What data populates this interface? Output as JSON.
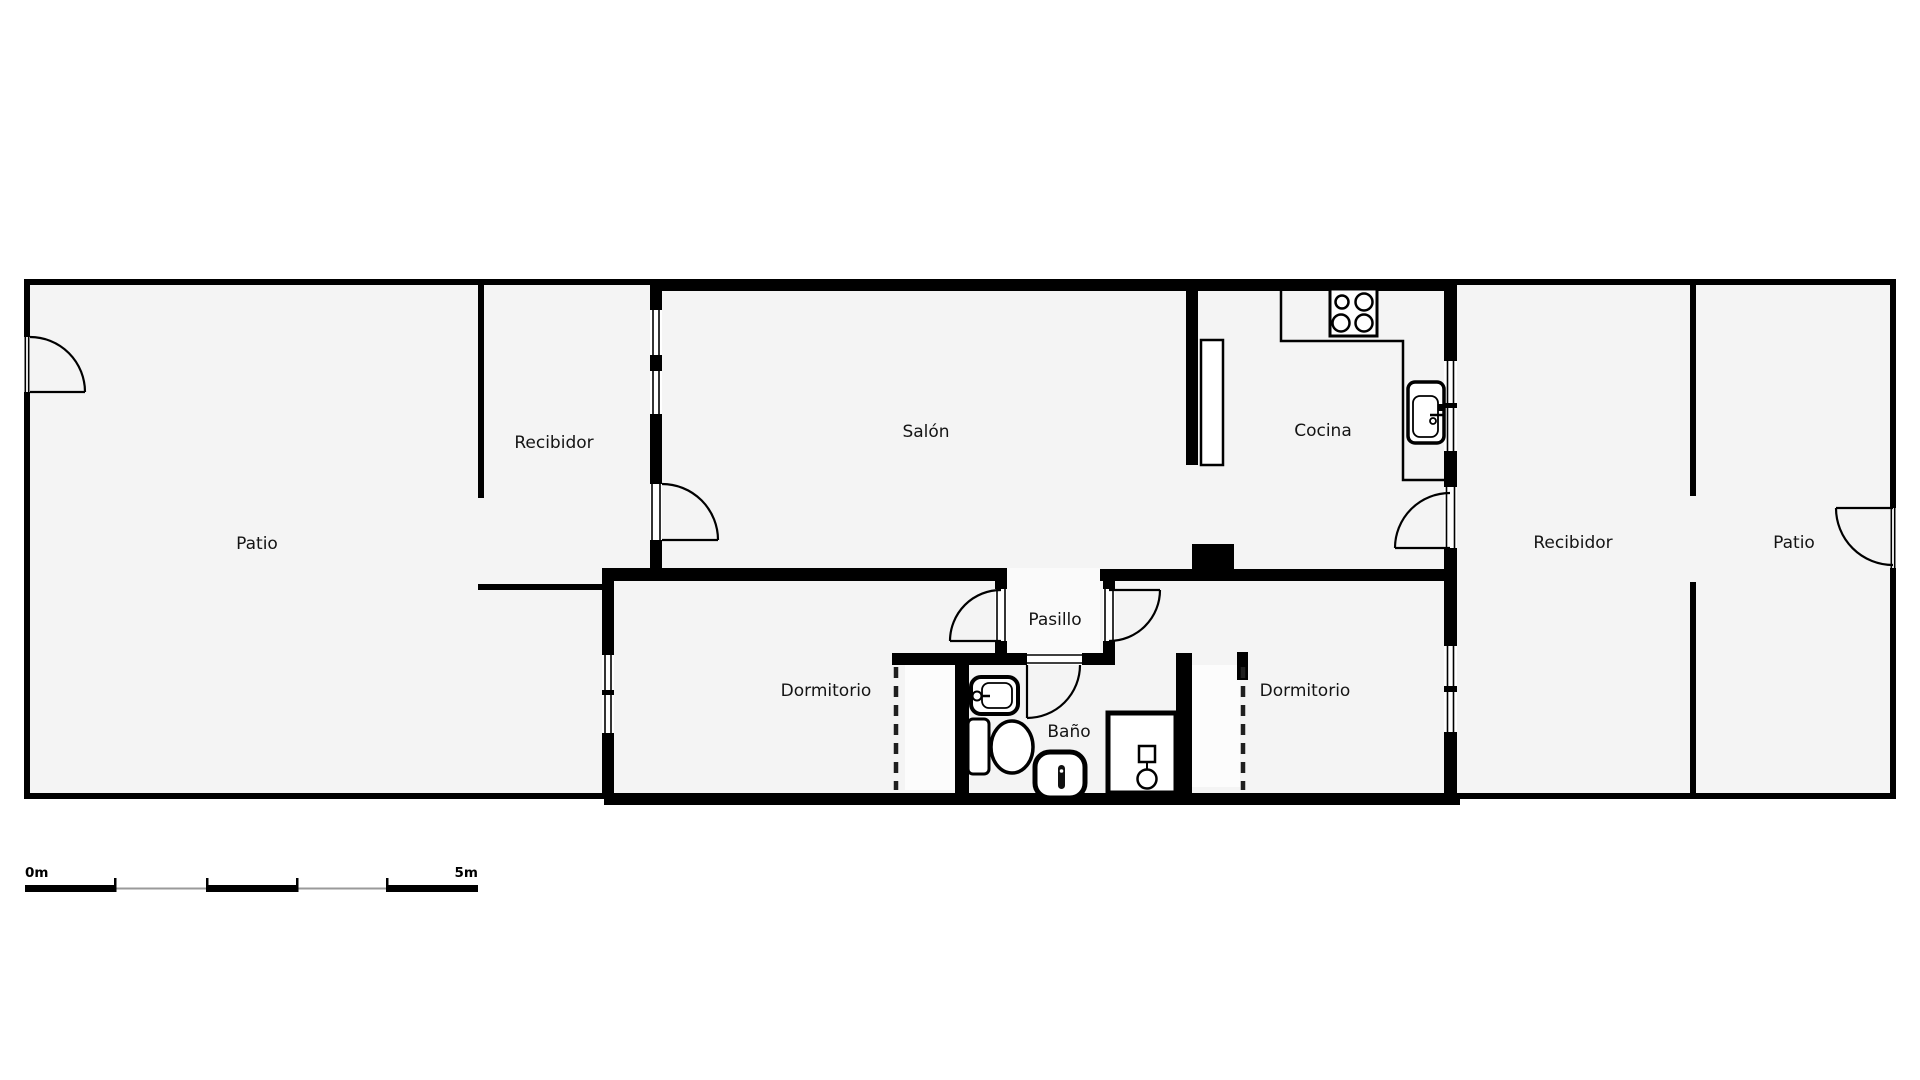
{
  "rooms": {
    "patio_left": "Patio",
    "recibidor_left": "Recibidor",
    "salon": "Salón",
    "cocina": "Cocina",
    "pasillo": "Pasillo",
    "dormitorio_left": "Dormitorio",
    "bano": "Baño",
    "dormitorio_right": "Dormitorio",
    "recibidor_right": "Recibidor",
    "patio_right": "Patio"
  },
  "scale_bar": {
    "start_label": "0m",
    "end_label": "5m"
  },
  "colors": {
    "wall": "#000000",
    "floor": "#f4f4f4",
    "floor_light": "#fafafa",
    "floor_bright": "#fcfcfc",
    "background": "#ffffff",
    "scale_gray": "#9a9a9a",
    "text": "#141414"
  },
  "fixtures": {
    "stove": "stove-icon",
    "kitchen_sink": "kitchen-sink-icon",
    "bathroom_sink": "bathroom-sink-icon",
    "toilet": "toilet-icon",
    "bidet": "bidet-icon",
    "shower": "shower-icon",
    "wardrobe_left": "wardrobe-dashed-left",
    "wardrobe_right": "wardrobe-dashed-right"
  }
}
